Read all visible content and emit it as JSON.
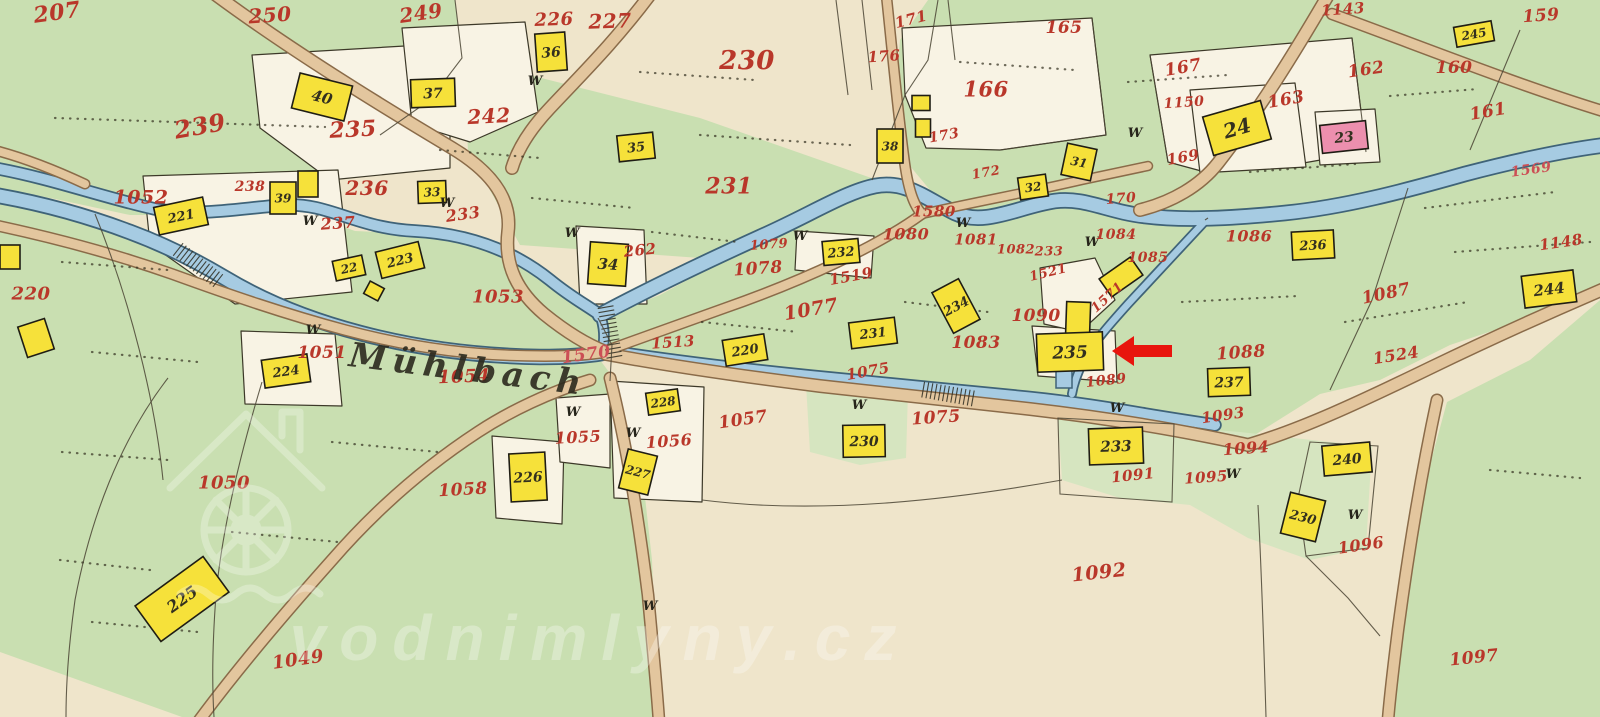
{
  "map": {
    "river_label": "Mühlbach",
    "watermark": {
      "text": "vodnimlyny.cz"
    },
    "w_glyph": "W",
    "colors": {
      "meadow": "#c9dfb1",
      "meadow_pale": "#d6e5c0",
      "field": "#efe5cb",
      "parcel_white": "#f8f3e4",
      "water_fill": "#a6cbe2",
      "water_edge": "#3f6378",
      "road_fill": "#e3c69e",
      "road_edge": "#8a6b49",
      "building_yellow": "#f6e13a",
      "building_pink": "#ec8fae",
      "ink": "#33301f",
      "label_red": "#b9372a",
      "label_water": "#cc4f55",
      "arrow_red": "#e8150d",
      "watermark": "#ffffff"
    },
    "buildings": [
      {
        "l": "40",
        "x": 322,
        "y": 97,
        "w": 54,
        "h": 36,
        "r": 14,
        "ls": 15
      },
      {
        "l": "37",
        "x": 433,
        "y": 93,
        "w": 44,
        "h": 28,
        "r": -2,
        "ls": 14
      },
      {
        "l": "36",
        "x": 551,
        "y": 52,
        "w": 30,
        "h": 38,
        "r": -4,
        "ls": 14
      },
      {
        "l": "35",
        "x": 636,
        "y": 147,
        "w": 36,
        "h": 26,
        "r": -6,
        "ls": 13
      },
      {
        "l": "33",
        "x": 432,
        "y": 192,
        "w": 28,
        "h": 22,
        "r": -2,
        "ls": 12
      },
      {
        "l": "38",
        "x": 890,
        "y": 146,
        "w": 26,
        "h": 34,
        "r": 0,
        "ls": 12
      },
      {
        "l": "",
        "x": 921,
        "y": 103,
        "w": 18,
        "h": 15,
        "r": 0
      },
      {
        "l": "",
        "x": 923,
        "y": 128,
        "w": 15,
        "h": 18,
        "r": 0
      },
      {
        "l": "32",
        "x": 1033,
        "y": 187,
        "w": 28,
        "h": 22,
        "r": -8,
        "ls": 12
      },
      {
        "l": "31",
        "x": 1079,
        "y": 162,
        "w": 30,
        "h": 32,
        "r": 12,
        "ls": 12
      },
      {
        "l": "24",
        "x": 1237,
        "y": 128,
        "w": 60,
        "h": 40,
        "r": -16,
        "ls": 20
      },
      {
        "l": "23",
        "x": 1344,
        "y": 137,
        "w": 46,
        "h": 28,
        "r": -6,
        "fill": "pink",
        "ls": 14
      },
      {
        "l": "245",
        "x": 1474,
        "y": 34,
        "w": 38,
        "h": 20,
        "r": -10,
        "ls": 12
      },
      {
        "l": "236",
        "x": 1313,
        "y": 245,
        "w": 42,
        "h": 28,
        "r": -3,
        "ls": 13
      },
      {
        "l": "244",
        "x": 1549,
        "y": 289,
        "w": 52,
        "h": 32,
        "r": -7,
        "ls": 15
      },
      {
        "l": "221",
        "x": 181,
        "y": 216,
        "w": 50,
        "h": 28,
        "r": -12,
        "ls": 13
      },
      {
        "l": "39",
        "x": 283,
        "y": 198,
        "w": 26,
        "h": 32,
        "r": 0,
        "ls": 12
      },
      {
        "l": "",
        "x": 308,
        "y": 184,
        "w": 20,
        "h": 26,
        "r": 0
      },
      {
        "l": "22",
        "x": 349,
        "y": 268,
        "w": 30,
        "h": 20,
        "r": -12,
        "ls": 12
      },
      {
        "l": "",
        "x": 374,
        "y": 291,
        "w": 16,
        "h": 14,
        "r": 28
      },
      {
        "l": "223",
        "x": 400,
        "y": 260,
        "w": 44,
        "h": 27,
        "r": -14,
        "ls": 13
      },
      {
        "l": "34",
        "x": 608,
        "y": 264,
        "w": 38,
        "h": 42,
        "r": 4,
        "ls": 15
      },
      {
        "l": "232",
        "x": 841,
        "y": 252,
        "w": 36,
        "h": 24,
        "r": -5,
        "ls": 13
      },
      {
        "l": "231",
        "x": 873,
        "y": 333,
        "w": 46,
        "h": 26,
        "r": -7,
        "ls": 13
      },
      {
        "l": "234",
        "x": 956,
        "y": 306,
        "w": 30,
        "h": 46,
        "r": -28,
        "ls": 13
      },
      {
        "l": "220",
        "x": 745,
        "y": 350,
        "w": 42,
        "h": 26,
        "r": -9,
        "ls": 13
      },
      {
        "l": "",
        "x": 1121,
        "y": 277,
        "w": 38,
        "h": 22,
        "r": -35
      },
      {
        "l": "",
        "x": 1078,
        "y": 322,
        "w": 24,
        "h": 40,
        "r": 2
      },
      {
        "l": "235",
        "x": 1070,
        "y": 352,
        "w": 66,
        "h": 38,
        "r": -2,
        "ls": 17
      },
      {
        "l": "237",
        "x": 1229,
        "y": 382,
        "w": 42,
        "h": 28,
        "r": -2,
        "ls": 14
      },
      {
        "l": "230",
        "x": 864,
        "y": 441,
        "w": 42,
        "h": 32,
        "r": -1,
        "ls": 14
      },
      {
        "l": "233",
        "x": 1116,
        "y": 446,
        "w": 54,
        "h": 36,
        "r": -2,
        "ls": 15
      },
      {
        "l": "240",
        "x": 1347,
        "y": 459,
        "w": 48,
        "h": 30,
        "r": -5,
        "ls": 14
      },
      {
        "l": "230",
        "x": 1303,
        "y": 517,
        "w": 36,
        "h": 42,
        "r": 14,
        "ls": 13
      },
      {
        "l": "226",
        "x": 528,
        "y": 477,
        "w": 36,
        "h": 48,
        "r": -3,
        "ls": 14
      },
      {
        "l": "228",
        "x": 663,
        "y": 402,
        "w": 32,
        "h": 22,
        "r": -8,
        "ls": 12
      },
      {
        "l": "227",
        "x": 638,
        "y": 472,
        "w": 30,
        "h": 40,
        "r": 14,
        "ls": 12
      },
      {
        "l": "225",
        "x": 182,
        "y": 599,
        "w": 84,
        "h": 44,
        "r": -36,
        "ls": 16
      },
      {
        "l": "224",
        "x": 286,
        "y": 371,
        "w": 46,
        "h": 28,
        "r": -8,
        "ls": 13
      },
      {
        "l": "",
        "x": 36,
        "y": 338,
        "w": 28,
        "h": 32,
        "r": -18
      },
      {
        "l": "",
        "x": 10,
        "y": 257,
        "w": 20,
        "h": 24,
        "r": 0
      }
    ],
    "parcel_labels": [
      [
        "207",
        57,
        12,
        22,
        -8
      ],
      [
        "250",
        270,
        15,
        20,
        -4
      ],
      [
        "249",
        421,
        13,
        20,
        -8
      ],
      [
        "226",
        554,
        19,
        18,
        -2
      ],
      [
        "227",
        610,
        21,
        20,
        -2
      ],
      [
        "230",
        747,
        60,
        26,
        0
      ],
      [
        "235",
        353,
        129,
        22,
        -3
      ],
      [
        "239",
        200,
        126,
        24,
        -10
      ],
      [
        "242",
        489,
        116,
        20,
        -3
      ],
      [
        "236",
        367,
        188,
        20,
        0
      ],
      [
        "238",
        250,
        186,
        14,
        0
      ],
      [
        "237",
        338,
        223,
        16,
        -4
      ],
      [
        "233",
        463,
        214,
        16,
        -8
      ],
      [
        "231",
        729,
        186,
        22,
        0
      ],
      [
        "262",
        640,
        250,
        15,
        -6
      ],
      [
        "1052",
        141,
        197,
        19,
        0
      ],
      [
        "1053",
        498,
        296,
        18,
        0
      ],
      [
        "1054",
        464,
        376,
        18,
        -2
      ],
      [
        "1051",
        322,
        352,
        17,
        0
      ],
      [
        "220",
        31,
        293,
        18,
        0
      ],
      [
        "1050",
        224,
        482,
        18,
        0
      ],
      [
        "1049",
        298,
        659,
        18,
        -8
      ],
      [
        "1058",
        463,
        489,
        17,
        -3
      ],
      [
        "1055",
        578,
        437,
        16,
        -3
      ],
      [
        "1056",
        669,
        441,
        16,
        -4
      ],
      [
        "1057",
        743,
        419,
        17,
        -8
      ],
      [
        "1570",
        586,
        354,
        17,
        -8,
        "water"
      ],
      [
        "1513",
        673,
        342,
        15,
        -4
      ],
      [
        "1075",
        868,
        371,
        15,
        -10
      ],
      [
        "1075",
        936,
        417,
        17,
        -4
      ],
      [
        "1077",
        811,
        309,
        19,
        -10
      ],
      [
        "1078",
        758,
        268,
        17,
        -4
      ],
      [
        "1079",
        769,
        244,
        13,
        -4
      ],
      [
        "1519",
        851,
        276,
        15,
        -10
      ],
      [
        "1580",
        934,
        211,
        15,
        0
      ],
      [
        "1080",
        906,
        234,
        16,
        0
      ],
      [
        "1081",
        976,
        239,
        15,
        0
      ],
      [
        "1082",
        1016,
        249,
        13,
        0
      ],
      [
        "233",
        1049,
        251,
        13,
        0
      ],
      [
        "1521",
        1048,
        272,
        13,
        -14
      ],
      [
        "1084",
        1116,
        234,
        14,
        0
      ],
      [
        "1085",
        1148,
        257,
        14,
        0
      ],
      [
        "1086",
        1249,
        236,
        16,
        0
      ],
      [
        "1087",
        1386,
        293,
        17,
        -12
      ],
      [
        "1090",
        1036,
        315,
        17,
        0
      ],
      [
        "1083",
        976,
        342,
        17,
        0
      ],
      [
        "1571",
        1107,
        297,
        13,
        -42
      ],
      [
        "1088",
        1241,
        352,
        17,
        -4
      ],
      [
        "1089",
        1106,
        380,
        14,
        -6
      ],
      [
        "1091",
        1133,
        475,
        15,
        -6
      ],
      [
        "1092",
        1099,
        572,
        19,
        -6
      ],
      [
        "1093",
        1223,
        415,
        15,
        -8
      ],
      [
        "1094",
        1246,
        448,
        16,
        -4
      ],
      [
        "1095",
        1206,
        477,
        15,
        -4
      ],
      [
        "1096",
        1361,
        545,
        16,
        -8
      ],
      [
        "1097",
        1474,
        657,
        17,
        -6
      ],
      [
        "1524",
        1396,
        355,
        16,
        -9
      ],
      [
        "1143",
        1343,
        9,
        15,
        -4
      ],
      [
        "1148",
        1561,
        242,
        15,
        -8
      ],
      [
        "1569",
        1531,
        169,
        14,
        -8,
        "water"
      ],
      [
        "159",
        1541,
        15,
        17,
        -4
      ],
      [
        "160",
        1454,
        67,
        17,
        0
      ],
      [
        "161",
        1488,
        111,
        17,
        -10
      ],
      [
        "162",
        1366,
        69,
        17,
        -8
      ],
      [
        "163",
        1286,
        99,
        17,
        -10
      ],
      [
        "165",
        1064,
        27,
        17,
        0
      ],
      [
        "166",
        986,
        89,
        21,
        0
      ],
      [
        "167",
        1183,
        67,
        17,
        -10
      ],
      [
        "1150",
        1184,
        102,
        14,
        -4
      ],
      [
        "169",
        1183,
        157,
        15,
        -10
      ],
      [
        "170",
        1121,
        198,
        14,
        -4
      ],
      [
        "171",
        911,
        19,
        15,
        -14
      ],
      [
        "176",
        884,
        56,
        15,
        -4
      ],
      [
        "173",
        944,
        135,
        14,
        -10
      ],
      [
        "172",
        986,
        172,
        13,
        -10
      ]
    ],
    "w_marks": [
      [
        310,
        225
      ],
      [
        447,
        207
      ],
      [
        535,
        85
      ],
      [
        572,
        237
      ],
      [
        313,
        334
      ],
      [
        573,
        416
      ],
      [
        633,
        437
      ],
      [
        859,
        409
      ],
      [
        1117,
        412
      ],
      [
        1233,
        478
      ],
      [
        1355,
        519
      ],
      [
        963,
        227
      ],
      [
        1135,
        137
      ],
      [
        800,
        240
      ],
      [
        1092,
        246
      ],
      [
        650,
        610
      ]
    ],
    "annotation": {
      "shape": "arrow-left",
      "tip": [
        1112,
        351
      ],
      "tail": [
        1172,
        351
      ]
    }
  }
}
